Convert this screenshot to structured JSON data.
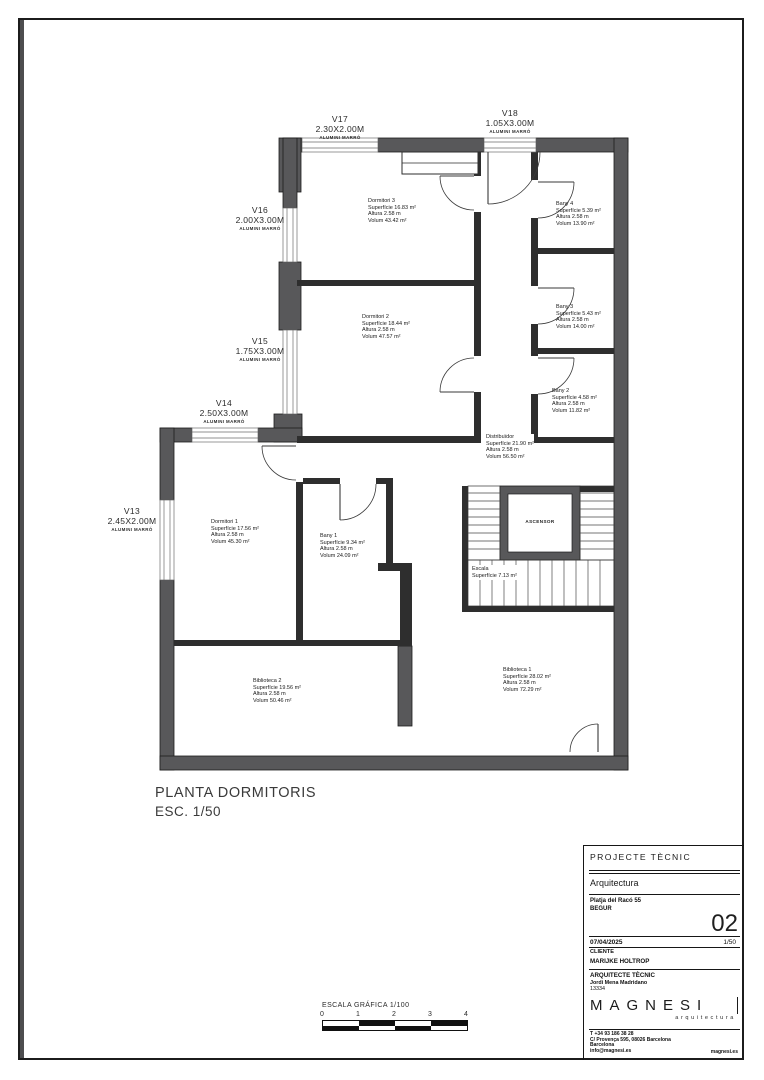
{
  "colors": {
    "exterior_wall_fill": "#58585a",
    "interior_wall_fill": "#2e2e2e",
    "line": "#1c1c1c"
  },
  "titles": {
    "plan_title": "PLANTA DORMITORIS",
    "plan_scale": "ESC. 1/50"
  },
  "plan": {
    "rooms": {
      "dormitori3": {
        "name": "Dormitori 3",
        "area": "Superfície 16.83 m²",
        "height": "Altura 2.58 m",
        "volume": "Volum 43.42 m²"
      },
      "dormitori2": {
        "name": "Dormitori 2",
        "area": "Superfície 18.44 m²",
        "height": "Altura 2.58 m",
        "volume": "Volum 47.57 m²"
      },
      "bany4": {
        "name": "Bany 4",
        "area": "Superfície 5.39 m²",
        "height": "Altura 2.58 m",
        "volume": "Volum 13.90 m²"
      },
      "bany3": {
        "name": "Bany 3",
        "area": "Superfície 5.43 m²",
        "height": "Altura 2.58 m",
        "volume": "Volum 14.00 m²"
      },
      "bany2": {
        "name": "Bany 2",
        "area": "Superfície 4.58 m²",
        "height": "Altura 2.58 m",
        "volume": "Volum 11.82 m²"
      },
      "distribuidor": {
        "name": "Distribuïdor",
        "area": "Superfície 21.90 m²",
        "height": "Altura 2.58 m",
        "volume": "Volum 56.50 m²"
      },
      "dormitori1": {
        "name": "Dormitori 1",
        "area": "Superfície 17.56 m²",
        "height": "Altura 2.58 m",
        "volume": "Volum 45.30 m²"
      },
      "bany1": {
        "name": "Bany 1",
        "area": "Superfície 9.34 m²",
        "height": "Altura 2.58 m",
        "volume": "Volum 24.09 m²"
      },
      "escala": {
        "name": "Escala",
        "area": "Superfície 7.13 m²"
      },
      "ascensor": {
        "name": "ASCENSOR"
      },
      "biblioteca2": {
        "name": "Biblioteca 2",
        "area": "Superfície 19.56 m²",
        "height": "Altura 2.58 m",
        "volume": "Volum 50.46 m²"
      },
      "biblioteca1": {
        "name": "Biblioteca 1",
        "area": "Superfície 28.02 m²",
        "height": "Altura 2.58 m",
        "volume": "Volum 72.29 m²"
      }
    },
    "windows": {
      "v13": {
        "id": "V13",
        "size": "2.45X2.00M",
        "frame": "ALUMINI MARRÓ"
      },
      "v14": {
        "id": "V14",
        "size": "2.50X3.00M",
        "frame": "ALUMINI MARRÓ"
      },
      "v15": {
        "id": "V15",
        "size": "1.75X3.00M",
        "frame": "ALUMINI MARRÓ"
      },
      "v16": {
        "id": "V16",
        "size": "2.00X3.00M",
        "frame": "ALUMINI MARRÓ"
      },
      "v17": {
        "id": "V17",
        "size": "2.30X2.00M",
        "frame": "ALUMINI MARRÓ"
      },
      "v18": {
        "id": "V18",
        "size": "1.05X3.00M",
        "frame": "ALUMINI MARRÓ"
      }
    }
  },
  "scale_bar": {
    "label": "ESCALA GRÁFICA 1/100",
    "ticks": [
      "0",
      "1",
      "2",
      "3",
      "4"
    ]
  },
  "title_block": {
    "header": "PROJECTE TÈCNIC",
    "discipline": "Arquitectura",
    "address_line1": "Platja del Racó 55",
    "address_line2": "BEGUR",
    "sheet_number": "02",
    "date": "07/04/2025",
    "scale": "1/50",
    "client_label": "CLIENTE",
    "client_name": "MARIJKE HOLTROP",
    "architect_label": "ARQUITECTE TÈCNIC",
    "architect_name": "Jordi Mena Madridano",
    "architect_number": "13334",
    "logo": "MAGNESI",
    "logo_sub": "arquitectura",
    "contact_phone": "T +34 93 186 38 28",
    "contact_address": "C/ Provença 595, 08026 Barcelona",
    "contact_city": "Barcelona",
    "contact_email": "info@magnesi.es",
    "contact_web": "magnesi.es"
  }
}
